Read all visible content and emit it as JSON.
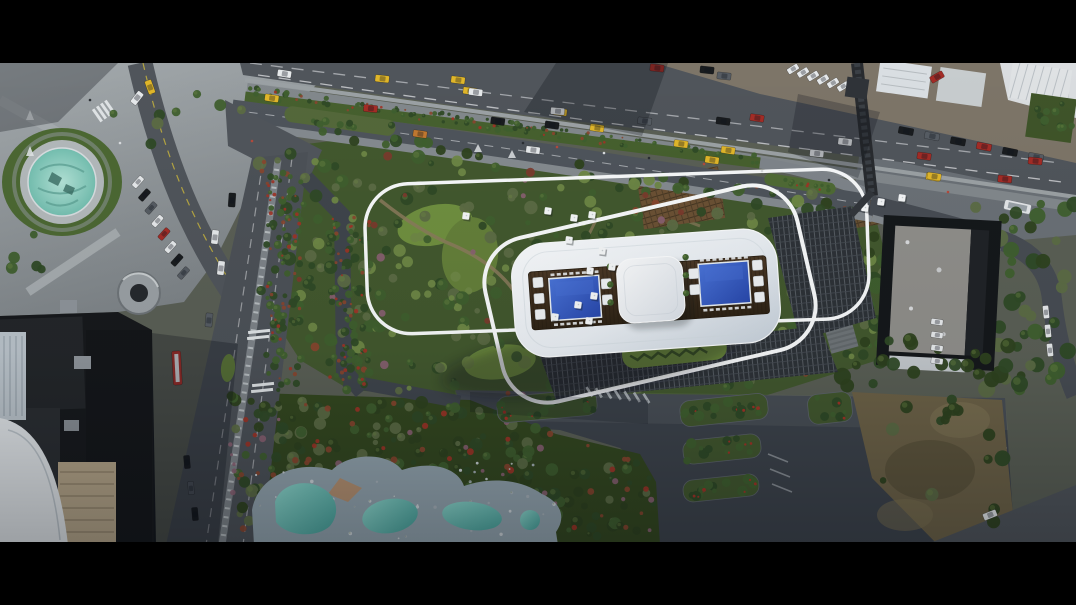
{
  "scene": {
    "type": "aerial-architectural-rendering",
    "description": "Top-down aerial rendering of a high-rise development: a white rounded rooftop with twin royal-blue swimming pools and a central skylight canopy on a landscaped garden podium with olive trees, winding paths and white sun umbrellas; a circular teal fountain plaza at upper left; a multi-lane highway with cars and yellow taxis and a pedestrian overpass along the top; surface parking with planted islands; a free-form lagoon pool; neighboring flat-roofed buildings and a vacant brown lot; black letterbox bars at top and bottom.",
    "camera": "orthographic top-down",
    "time_of_day": "late afternoon with long shadows"
  },
  "features": [
    "rooftop with twin pools and skylight canopy",
    "garden podium with white curved outline",
    "sun umbrellas on wooden decks",
    "circular teal fountain plaza",
    "multi-lane highway with taxis",
    "pedestrian overpass",
    "boulevard with median and crosswalks",
    "surface parking with planted islands",
    "lagoon-style free-form pool",
    "flat-roof office building with parked cars",
    "vacant brown lot",
    "shopping mall block with spiral ramp",
    "hedge rows with red flowers",
    "letterbox bars"
  ],
  "palette": {
    "letterbox": "#000000",
    "base": "#5a5f55",
    "pavement": "#969c9f",
    "pavement_dark": "#7e8487",
    "asphalt": "#50555b",
    "asphalt_dark": "#3d434b",
    "asphalt_light": "#666b71",
    "lane_white": "#e8eaec",
    "lane_yellow": "#cdb93c",
    "roof_white": "#f1f3f6",
    "roof_shade": "#c9d3dc",
    "outline_white": "#f7f9fa",
    "deck_brown": "#3f3122",
    "pool_blue": "#2f55c0",
    "pool_blue_light": "#4a74d8",
    "canopy_white": "#eef0f3",
    "fountain_teal": "#93d3c7",
    "lagoon_teal": "#62bdb4",
    "lagoon_stone": "#93a4ae",
    "lawn": "#6f8f3f",
    "lawn_bright": "#7fa24a",
    "garden_green": "#42582e",
    "garden_dark": "#2e421f",
    "tree_green1": "#2f4a26",
    "tree_green2": "#3f5f2e",
    "tree_olive": "#5c6b44",
    "tree_light": "#6e8746",
    "blossom_pink": "#8a6172",
    "blossom_red": "#7c3a2c",
    "rust": "#8a452e",
    "red_flower": "#a03326",
    "dark_roof": "#17191c",
    "beige": "#b3a387",
    "white_bldg": "#d9dee2",
    "gray_roof": "#8f8e8a",
    "pergola": "#6b5134",
    "taxi": "#e0b62a",
    "car_red": "#a32c26",
    "car_white": "#e6e9eb",
    "car_black": "#191c1f",
    "car_gray": "#565c63",
    "bus_red": "#b5342b",
    "bridge_dark": "#282b2f",
    "dirt": "#6d6247",
    "dirt_dark": "#585038"
  }
}
